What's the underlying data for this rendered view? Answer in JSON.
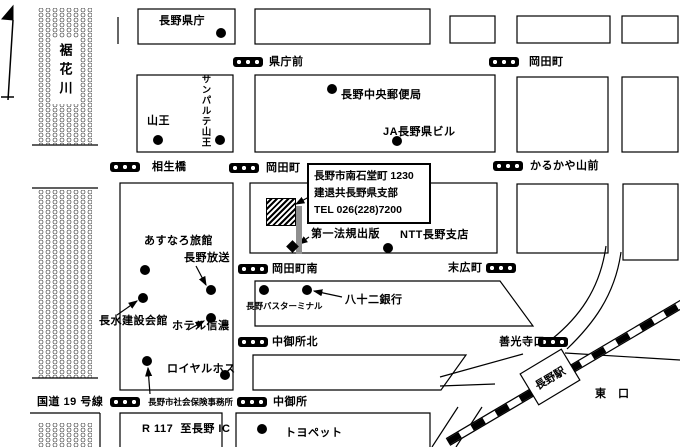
{
  "river": {
    "name": "裾花川"
  },
  "station": {
    "name": "長野駅"
  },
  "callout": {
    "lines": [
      "長野市南石堂町 1230",
      "建退共長野県支部",
      "TEL 026(228)7200"
    ]
  },
  "bus_stops": [
    {
      "name": "県庁前",
      "icon": [
        233,
        57
      ],
      "label": [
        269,
        57
      ]
    },
    {
      "name": "岡田町",
      "icon": [
        489,
        57
      ],
      "label": [
        529,
        57
      ]
    },
    {
      "name": "相生橋",
      "icon": [
        110,
        162
      ],
      "label": [
        152,
        162
      ]
    },
    {
      "name": "岡田町",
      "icon": [
        229,
        163
      ],
      "label": [
        266,
        163
      ]
    },
    {
      "name": "かるかや山前",
      "icon": [
        493,
        161
      ],
      "label": [
        530,
        161
      ]
    },
    {
      "name": "岡田町南",
      "icon": [
        238,
        264
      ],
      "label": [
        272,
        264
      ]
    },
    {
      "name": "末広町",
      "icon": [
        486,
        263
      ],
      "label": [
        448,
        263
      ]
    },
    {
      "name": "中御所北",
      "icon": [
        238,
        337
      ],
      "label": [
        272,
        337
      ]
    },
    {
      "name": "善光寺口",
      "icon": [
        538,
        337
      ],
      "label": [
        499,
        337
      ]
    },
    {
      "name": "",
      "icon": [
        110,
        397
      ],
      "label": [
        0,
        0
      ]
    },
    {
      "name": "中御所",
      "icon": [
        237,
        397
      ],
      "label": [
        273,
        397
      ]
    }
  ],
  "landmarks": [
    {
      "name": "長野県庁",
      "label": [
        159,
        16
      ],
      "dot": [
        221,
        33
      ]
    },
    {
      "name": "山王",
      "label": [
        147,
        116
      ],
      "dot": [
        158,
        140
      ]
    },
    {
      "name": "サンパルテ山王",
      "label": [
        200,
        74
      ],
      "dot": [
        220,
        140
      ],
      "vertical": true
    },
    {
      "name": "長野中央郵便局",
      "label": [
        341,
        90
      ],
      "dot": [
        332,
        89
      ]
    },
    {
      "name": "JA長野県ビル",
      "label": [
        383,
        127
      ],
      "dot": [
        397,
        141
      ]
    },
    {
      "name": "あすなろ旅館",
      "label": [
        144,
        236
      ],
      "dot": [
        145,
        270
      ]
    },
    {
      "name": "長野放送",
      "label": [
        184,
        253
      ],
      "dot": [
        211,
        290
      ],
      "arrow": [
        196,
        266,
        206,
        285
      ]
    },
    {
      "name": "長水建設会館",
      "label": [
        99,
        316
      ],
      "dot": [
        143,
        298
      ],
      "arrow": [
        117,
        315,
        137,
        301
      ]
    },
    {
      "name": "ホテル信濃",
      "label": [
        172,
        321
      ],
      "dot": [
        211,
        318
      ],
      "arrow": [
        188,
        330,
        204,
        321
      ]
    },
    {
      "name": "ロイヤルホス",
      "label": [
        167,
        364
      ],
      "dot": [
        225,
        375
      ]
    },
    {
      "name": "長野市社会保険事務所",
      "label": [
        148,
        398
      ],
      "dot": [
        147,
        361
      ],
      "arrow": [
        150,
        394,
        148,
        368
      ],
      "small": true
    },
    {
      "name": "トヨペット",
      "label": [
        285,
        428
      ],
      "dot": [
        262,
        429
      ]
    },
    {
      "name": "第一法規出版",
      "label": [
        311,
        229
      ],
      "dot": [
        292,
        246
      ],
      "diamond": true,
      "arrow": [
        309,
        237,
        299,
        244
      ]
    },
    {
      "name": "NTT長野支店",
      "label": [
        400,
        230
      ],
      "dot": [
        388,
        248
      ]
    },
    {
      "name": "八十二銀行",
      "label": [
        345,
        295
      ],
      "dot": [
        307,
        290
      ],
      "arrow": [
        342,
        297,
        314,
        291
      ]
    },
    {
      "name": "長野バスターミナル",
      "label": [
        246,
        302
      ],
      "dot": [
        264,
        290
      ],
      "small": true
    }
  ],
  "road_labels": [
    {
      "text": "国道 19 号線",
      "pos": [
        37,
        397
      ]
    },
    {
      "text": "R 117  至長野 IC",
      "pos": [
        142,
        424
      ]
    },
    {
      "text": "東　口",
      "pos": [
        595,
        389
      ]
    }
  ]
}
